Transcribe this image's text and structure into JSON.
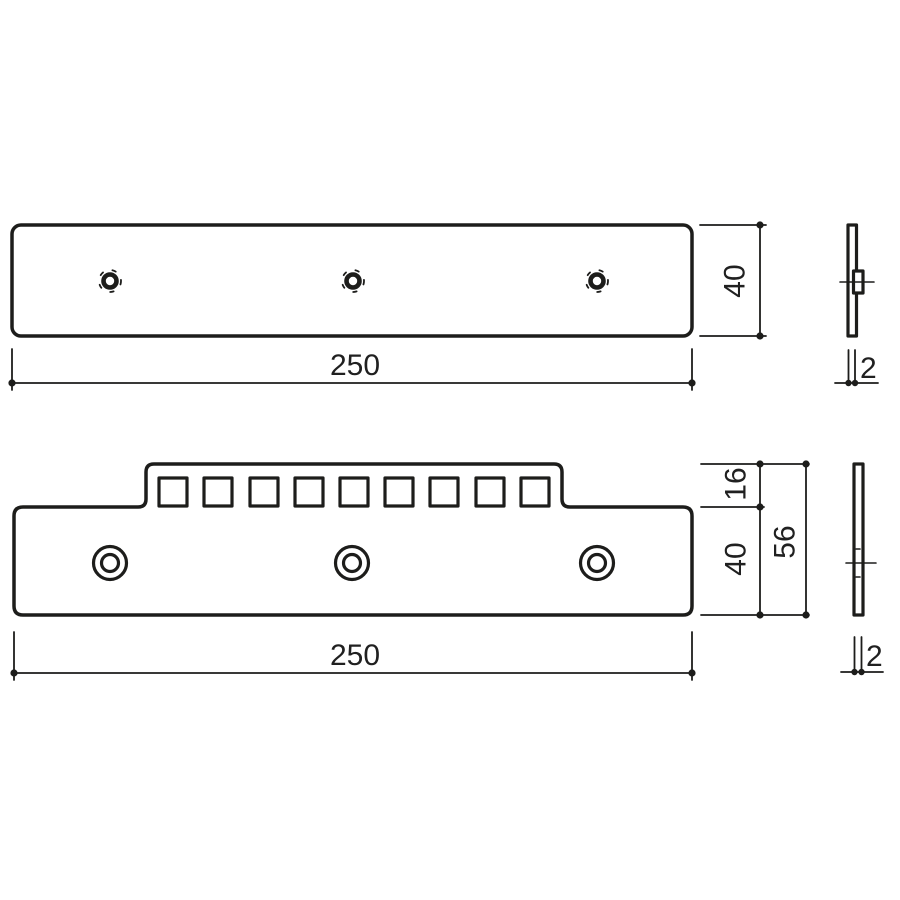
{
  "style": {
    "line_color": "#1d1d1b",
    "background": "#ffffff"
  },
  "views": {
    "flat_plate_front": {
      "width_label": "250",
      "height_label": "40"
    },
    "flat_plate_side": {
      "thickness_label": "2"
    },
    "notched_plate_front": {
      "width_label": "250",
      "tab_height_label": "16",
      "body_height_label": "40",
      "total_height_label": "56"
    },
    "notched_plate_side": {
      "thickness_label": "2"
    }
  }
}
